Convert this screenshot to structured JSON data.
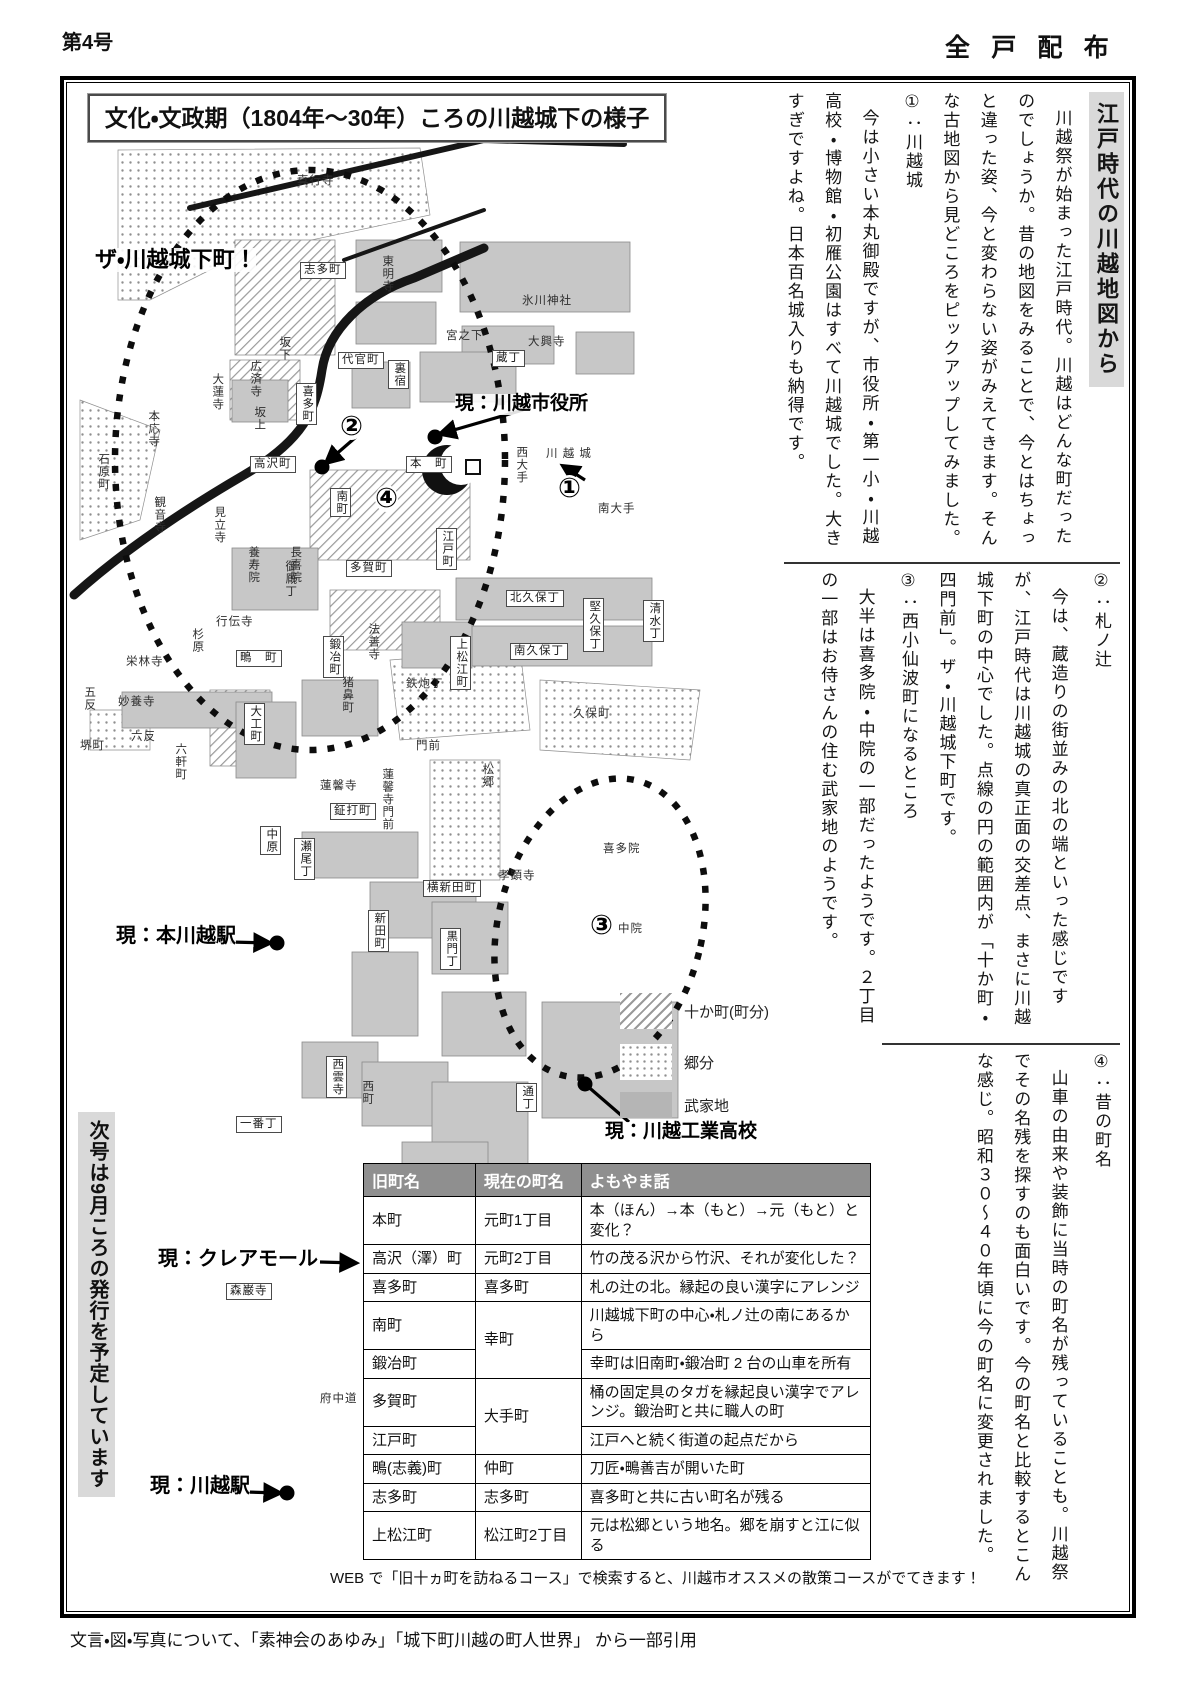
{
  "page": {
    "issue": "第4号",
    "distribution": "全戸配布",
    "footer": "文言・図・写真について、「素神会のあゆみ」「城下町川越の町人世界」 から一部引用"
  },
  "box": {
    "map_title": "文化・文政期（1804年～30年）ころの川越城下の様子",
    "web_note": "WEB で「旧十ヵ町を訪ねるコース」で検索すると、川越市オススメの散策コースがでてきます！",
    "next_issue_banner": "次号は9月ころの発行を予定しています"
  },
  "article": {
    "heading": "江戸時代の川越地図から",
    "blocks1": [
      {
        "type": "p",
        "text": "川越祭が始まった江戸時代。川越はどんな町だったのでしょうか。昔の地図をみることで、今とはちょっと違った姿、今と変わらない姿がみえてきます。そんな古地図から見どころをピックアップしてみました。"
      },
      {
        "type": "h",
        "text": "①：川越城"
      },
      {
        "type": "p",
        "text": "今は小さい本丸御殿ですが、市役所・第一小・川越高校・博物館・初雁公園はすべて川越城でした。大きすぎですよね。日本百名城入りも納得です。"
      }
    ],
    "blocks2": [
      {
        "type": "h",
        "text": "②：札ノ辻"
      },
      {
        "type": "p",
        "text": "今は、蔵造りの街並みの北の端といった感じですが、江戸時代は川越城の真正面の交差点、まさに川越城下町の中心でした。点線の円の範囲内が「十か町・四門前」。ザ・川越城下町です。"
      },
      {
        "type": "h",
        "text": "③：西小仙波町になるところ"
      },
      {
        "type": "p",
        "text": "大半は喜多院・中院の一部だったようです。２丁目の一部はお侍さんの住む武家地のようです。"
      }
    ],
    "blocks3": [
      {
        "type": "h",
        "text": "④：昔の町名"
      },
      {
        "type": "p",
        "text": "山車の由来や装飾に当時の町名が残っていることも。川越祭でその名残を探すのも面白いです。今の町名と比較するとこんな感じ。昭和３０～４０年頃に今の町名に変更されました。"
      }
    ]
  },
  "map": {
    "annotations": [
      {
        "t": "ザ・川越城下町！",
        "x": 95,
        "y": 248,
        "fs": 22
      },
      {
        "t": "現：川越市役所",
        "x": 455,
        "y": 394,
        "fs": 19
      },
      {
        "t": "現：本川越駅",
        "x": 116,
        "y": 925,
        "fs": 20
      },
      {
        "t": "現：クレアモール",
        "x": 158,
        "y": 1248,
        "fs": 20
      },
      {
        "t": "現：川越駅",
        "x": 150,
        "y": 1475,
        "fs": 20
      },
      {
        "t": "現：川越工業高校",
        "x": 605,
        "y": 1122,
        "fs": 19
      }
    ],
    "markers": [
      {
        "t": "①",
        "x": 558,
        "y": 475
      },
      {
        "t": "②",
        "x": 340,
        "y": 413
      },
      {
        "t": "③",
        "x": 590,
        "y": 912
      },
      {
        "t": "④",
        "x": 375,
        "y": 485
      }
    ],
    "legend": [
      {
        "swatch": "hatch",
        "label": "十か町(町分)",
        "x": 620,
        "y": 993
      },
      {
        "swatch": "dots",
        "label": "郷分",
        "x": 620,
        "y": 1044
      },
      {
        "swatch": "solid",
        "label": "武家地",
        "x": 620,
        "y": 1092
      }
    ],
    "labels": [
      {
        "t": "真行寺",
        "x": 297,
        "y": 175
      },
      {
        "t": "東明寺",
        "x": 380,
        "y": 255,
        "v": 1
      },
      {
        "t": "氷川神社",
        "x": 522,
        "y": 295
      },
      {
        "t": "宮之下",
        "x": 446,
        "y": 330
      },
      {
        "t": "大興寺",
        "x": 528,
        "y": 336
      },
      {
        "t": "志多町",
        "x": 300,
        "y": 262,
        "b": 1
      },
      {
        "t": "坂下",
        "x": 277,
        "y": 336,
        "v": 1
      },
      {
        "t": "広済寺",
        "x": 248,
        "y": 360,
        "v": 1
      },
      {
        "t": "坂上",
        "x": 252,
        "y": 406,
        "v": 1
      },
      {
        "t": "代官町",
        "x": 338,
        "y": 352,
        "b": 1
      },
      {
        "t": "喜多町",
        "x": 296,
        "y": 383,
        "v": 1,
        "b": 1
      },
      {
        "t": "裏宿",
        "x": 388,
        "y": 360,
        "v": 1,
        "b": 1
      },
      {
        "t": "蔵丁",
        "x": 492,
        "y": 350,
        "b": 1
      },
      {
        "t": "大蓮寺",
        "x": 210,
        "y": 373,
        "v": 1
      },
      {
        "t": "本応寺",
        "x": 146,
        "y": 410,
        "v": 1
      },
      {
        "t": "石原町",
        "x": 96,
        "y": 453,
        "v": 1
      },
      {
        "t": "観音寺",
        "x": 152,
        "y": 496,
        "v": 1
      },
      {
        "t": "見立寺",
        "x": 212,
        "y": 506,
        "v": 1
      },
      {
        "t": "養寿院",
        "x": 246,
        "y": 546,
        "v": 1
      },
      {
        "t": "御厩丁",
        "x": 283,
        "y": 560,
        "v": 1
      },
      {
        "t": "高沢町",
        "x": 250,
        "y": 456,
        "b": 1
      },
      {
        "t": "本　町",
        "x": 406,
        "y": 456,
        "b": 1
      },
      {
        "t": "南町",
        "x": 330,
        "y": 488,
        "v": 1,
        "b": 1
      },
      {
        "t": "多賀町",
        "x": 346,
        "y": 560,
        "b": 1
      },
      {
        "t": "江戸町",
        "x": 436,
        "y": 528,
        "v": 1,
        "b": 1
      },
      {
        "t": "西大手",
        "x": 514,
        "y": 446,
        "v": 1
      },
      {
        "t": "川 越 城",
        "x": 546,
        "y": 448
      },
      {
        "t": "南大手",
        "x": 598,
        "y": 503
      },
      {
        "t": "長喜院",
        "x": 288,
        "y": 546,
        "v": 1
      },
      {
        "t": "行伝寺",
        "x": 216,
        "y": 616
      },
      {
        "t": "鍛冶町",
        "x": 323,
        "y": 636,
        "v": 1,
        "b": 1
      },
      {
        "t": "法善寺",
        "x": 366,
        "y": 623,
        "v": 1
      },
      {
        "t": "北久保丁",
        "x": 506,
        "y": 590,
        "b": 1
      },
      {
        "t": "堅久保丁",
        "x": 583,
        "y": 598,
        "v": 1,
        "b": 1
      },
      {
        "t": "清水丁",
        "x": 643,
        "y": 600,
        "v": 1,
        "b": 1
      },
      {
        "t": "南久保丁",
        "x": 510,
        "y": 643,
        "b": 1
      },
      {
        "t": "栄林寺",
        "x": 126,
        "y": 656
      },
      {
        "t": "杉原",
        "x": 190,
        "y": 628,
        "v": 1
      },
      {
        "t": "鴫　町",
        "x": 236,
        "y": 650,
        "b": 1
      },
      {
        "t": "妙養寺",
        "x": 118,
        "y": 696
      },
      {
        "t": "五反",
        "x": 82,
        "y": 686,
        "v": 1
      },
      {
        "t": "六反",
        "x": 131,
        "y": 731
      },
      {
        "t": "堺町",
        "x": 80,
        "y": 740
      },
      {
        "t": "猪鼻町",
        "x": 340,
        "y": 676,
        "v": 1
      },
      {
        "t": "鉄炮丁",
        "x": 406,
        "y": 678
      },
      {
        "t": "上松江町",
        "x": 450,
        "y": 636,
        "v": 1,
        "b": 1
      },
      {
        "t": "門前",
        "x": 416,
        "y": 740
      },
      {
        "t": "久保町",
        "x": 573,
        "y": 708
      },
      {
        "t": "松郷",
        "x": 480,
        "y": 763,
        "v": 1
      },
      {
        "t": "大工町",
        "x": 244,
        "y": 703,
        "v": 1,
        "b": 1
      },
      {
        "t": "蓮馨寺",
        "x": 320,
        "y": 780
      },
      {
        "t": "蓮馨寺門前",
        "x": 380,
        "y": 768,
        "v": 1
      },
      {
        "t": "六軒町",
        "x": 173,
        "y": 743,
        "v": 1
      },
      {
        "t": "鉦打町",
        "x": 330,
        "y": 803,
        "b": 1
      },
      {
        "t": "中原",
        "x": 260,
        "y": 826,
        "v": 1,
        "b": 1
      },
      {
        "t": "瀬尾丁",
        "x": 294,
        "y": 838,
        "v": 1,
        "b": 1
      },
      {
        "t": "横新田町",
        "x": 423,
        "y": 880,
        "b": 1
      },
      {
        "t": "新田町",
        "x": 368,
        "y": 910,
        "v": 1,
        "b": 1
      },
      {
        "t": "黒門丁",
        "x": 440,
        "y": 928,
        "v": 1,
        "b": 1
      },
      {
        "t": "孝顕寺",
        "x": 498,
        "y": 870
      },
      {
        "t": "喜多院",
        "x": 603,
        "y": 843
      },
      {
        "t": "中院",
        "x": 618,
        "y": 923
      },
      {
        "t": "西雲寺",
        "x": 326,
        "y": 1056,
        "v": 1,
        "b": 1
      },
      {
        "t": "西町",
        "x": 360,
        "y": 1080,
        "v": 1
      },
      {
        "t": "一番丁",
        "x": 236,
        "y": 1116,
        "b": 1
      },
      {
        "t": "通丁",
        "x": 516,
        "y": 1083,
        "v": 1,
        "b": 1
      },
      {
        "t": "森巌寺",
        "x": 226,
        "y": 1283,
        "b": 1
      },
      {
        "t": "府中道",
        "x": 320,
        "y": 1393
      }
    ]
  },
  "table": {
    "headers": [
      "旧町名",
      "現在の町名",
      "よもやま話"
    ],
    "rows": [
      [
        {
          "t": "本町"
        },
        {
          "t": "元町1丁目"
        },
        {
          "t": "本（ほん）→本（もと）→元（もと）と変化？"
        }
      ],
      [
        {
          "t": "高沢（澤）町"
        },
        {
          "t": "元町2丁目"
        },
        {
          "t": "竹の茂る沢から竹沢、それが変化した？"
        }
      ],
      [
        {
          "t": "喜多町"
        },
        {
          "t": "喜多町"
        },
        {
          "t": "札の辻の北。縁起の良い漢字にアレンジ"
        }
      ],
      [
        {
          "t": "南町"
        },
        {
          "t": "幸町",
          "rs": 2
        },
        {
          "t": "川越城下町の中心・札ノ辻の南にあるから"
        }
      ],
      [
        {
          "t": "鍛冶町"
        },
        null,
        {
          "t": "幸町は旧南町・鍛冶町 2 台の山車を所有"
        }
      ],
      [
        {
          "t": "多賀町"
        },
        {
          "t": "大手町",
          "rs": 2
        },
        {
          "t": "桶の固定具のタガを縁起良い漢字でアレンジ。鍛治町と共に職人の町"
        }
      ],
      [
        {
          "t": "江戸町"
        },
        null,
        {
          "t": "江戸へと続く街道の起点だから"
        }
      ],
      [
        {
          "t": "鴫(志義)町"
        },
        {
          "t": "仲町"
        },
        {
          "t": "刀匠・鴫善吉が開いた町"
        }
      ],
      [
        {
          "t": "志多町"
        },
        {
          "t": "志多町"
        },
        {
          "t": "喜多町と共に古い町名が残る"
        }
      ],
      [
        {
          "t": "上松江町"
        },
        {
          "t": "松江町2丁目"
        },
        {
          "t": "元は松郷という地名。郷を崩すと江に似る"
        }
      ]
    ]
  }
}
